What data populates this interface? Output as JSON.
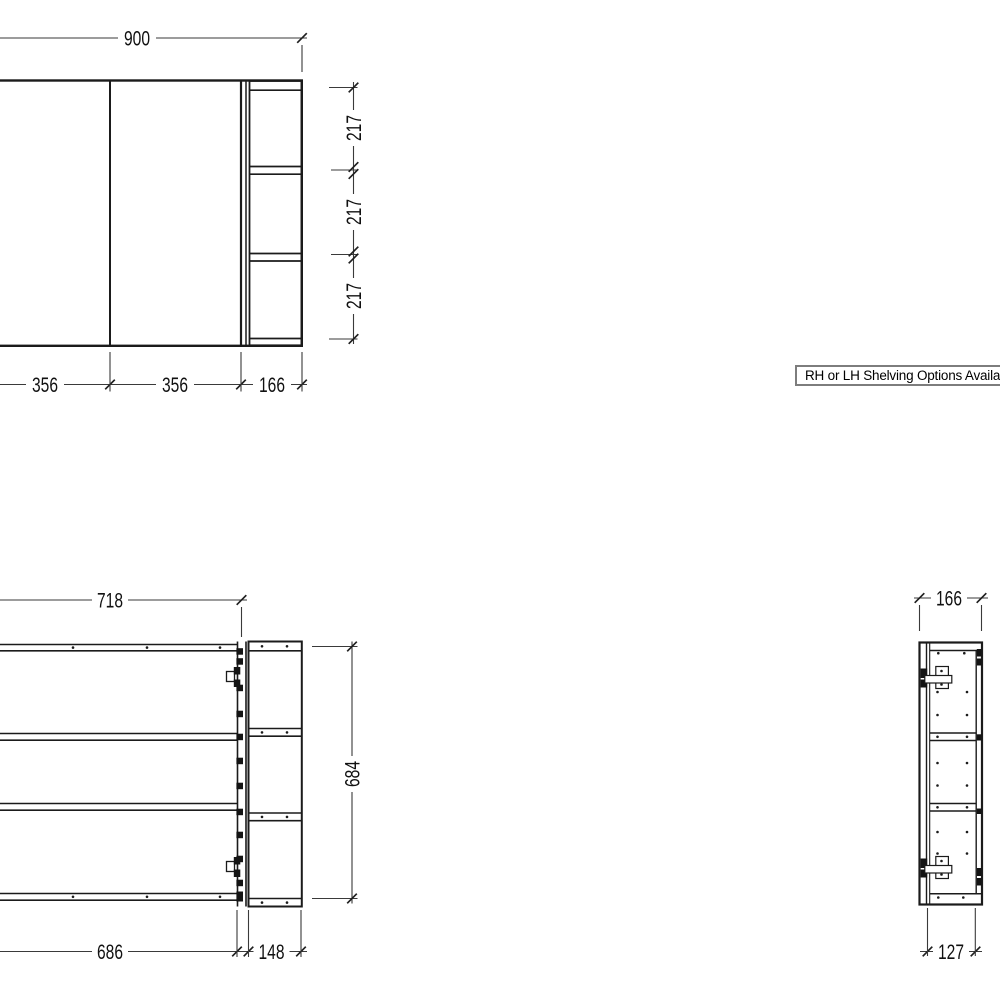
{
  "sheet": {
    "background": "#ffffff",
    "line_color": "#1b1b1b",
    "dim_line_color": "#3a3a3a",
    "text_color": "#111111"
  },
  "note_box": {
    "label": "RH or LH Shelving Options Available",
    "border_color": "#7d7d7d"
  },
  "front_view": {
    "dims": {
      "overall_width": "900",
      "door1_width": "356",
      "door2_width": "356",
      "shelving_width": "166",
      "opening1_height": "217",
      "opening2_height": "217",
      "opening3_height": "217"
    }
  },
  "carcass_view": {
    "dims": {
      "body_width": "718",
      "body_height": "684",
      "door_span_width": "686",
      "shelf_bay_width": "148"
    }
  },
  "side_view": {
    "dims": {
      "overall_depth": "166",
      "internal_depth": "127"
    }
  }
}
